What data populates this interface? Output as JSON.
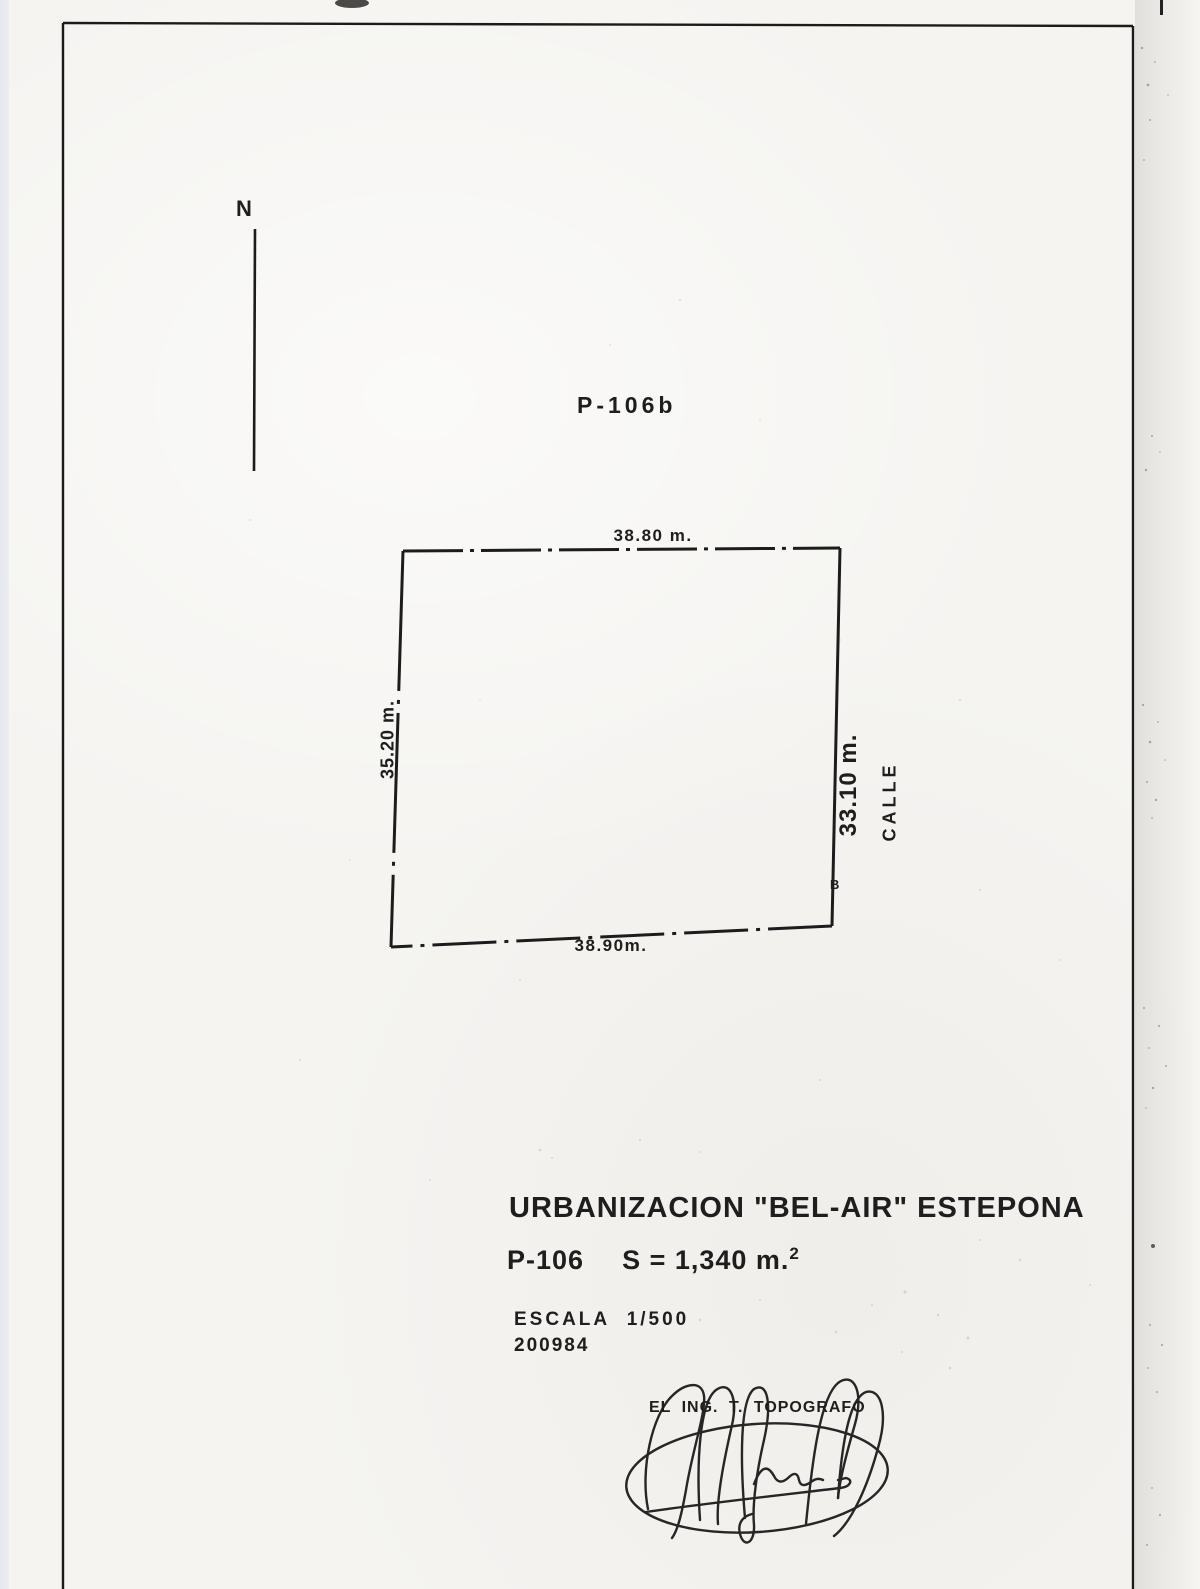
{
  "page": {
    "north_label": "N",
    "plan_code": "P-106b",
    "plot": {
      "top_dim": "38.80 m.",
      "bottom_dim": "38.90m.",
      "left_dim": "35.20 m.",
      "right_dim": "33.10 m.",
      "street_label": "CALLE",
      "corner_label": "B"
    },
    "title_block": {
      "title": "URBANIZACION \"BEL-AIR\" ESTEPONA",
      "parcel": "P-106",
      "area_main": "S = 1,340 m.",
      "area_exponent": "2",
      "scale_label": "ESCALA 1/500",
      "date_code": "200984",
      "signer_title": "EL ING. T. TOPOGRAFO"
    },
    "colors": {
      "ink": "#1f1f1f",
      "paper": "#f5f4f1"
    }
  }
}
